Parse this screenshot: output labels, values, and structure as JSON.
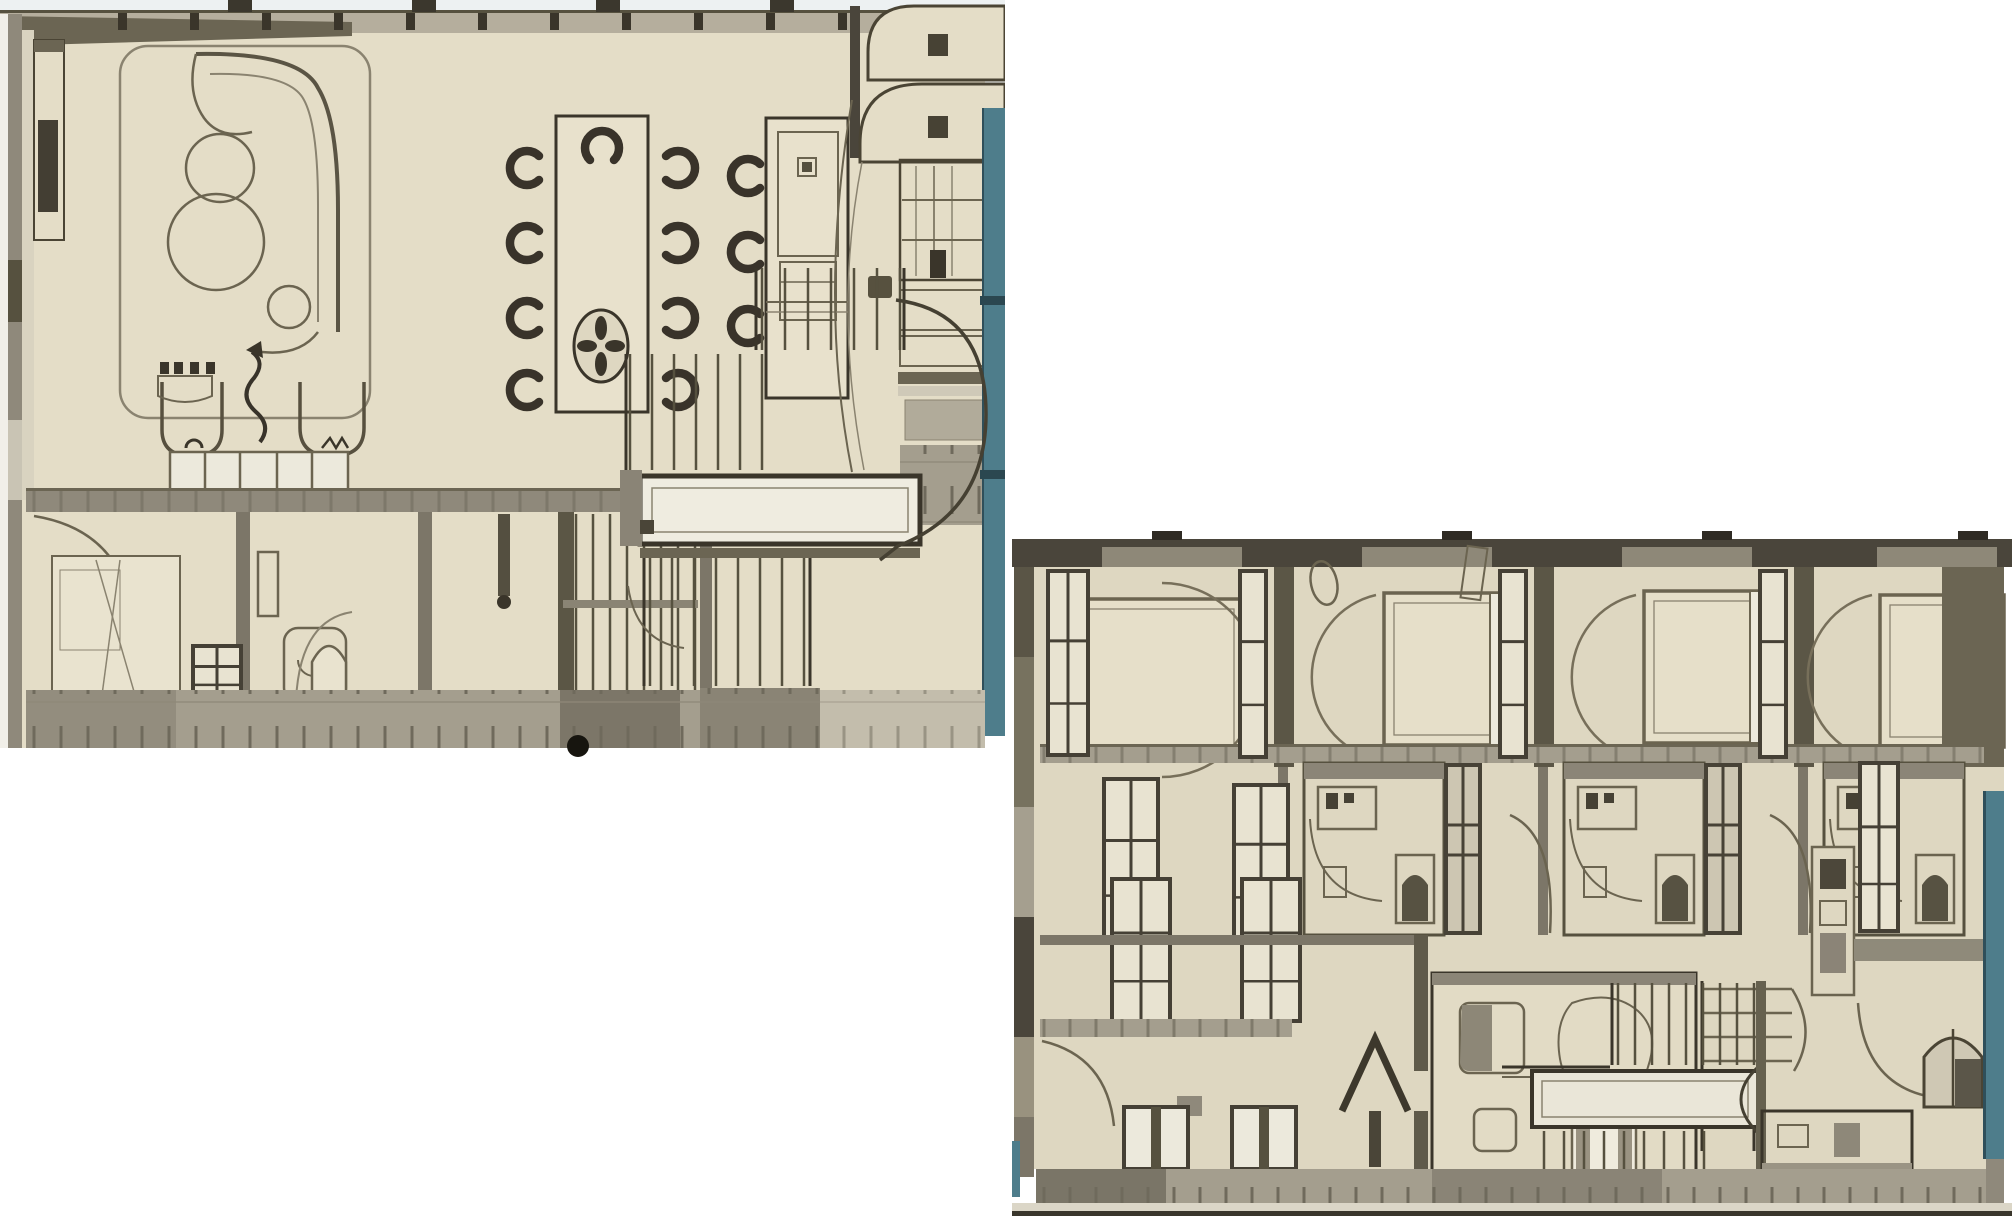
{
  "meta": {
    "description": "Two sepia hand-drawn architectural floor plans placed diagonally on a white background; no text labels are rendered in the image",
    "canvas": {
      "width": 2012,
      "height": 1216
    }
  },
  "palette": {
    "page_bg": "#ffffff",
    "top_light": "#edf1f2",
    "paper_a": "#e4ddc7",
    "paper_b": "#ded7c1",
    "paper_deep": "#d6cfba",
    "pane": "#ece9dc",
    "ink": "#4a4434",
    "ink_soft": "#8a8370",
    "line_mid": "#6b6450",
    "wall_dark": "#3a352a",
    "wall_olive": "#6b6553",
    "band_light": "#b5ae9d",
    "band_mid": "#a49e8e",
    "band_dark": "#7c7668",
    "gray_mid": "#8f897b",
    "gray_dark": "#56513f",
    "gray_deep": "#4a453b",
    "glass_teal": "#4e7d8b",
    "teal_dark": "#2f4f5a",
    "black": "#17150f",
    "chair_dark": "#39332a"
  },
  "panels": {
    "left": {
      "name": "living-dining-floor-plan",
      "x": 0,
      "y": 0,
      "w": 1005,
      "h": 762
    },
    "right": {
      "name": "bedroom-floor-plan",
      "x": 1012,
      "y": 511,
      "w": 1000,
      "h": 705
    }
  },
  "generated": {
    "top_ticks_a": {
      "y": 13,
      "w": 9,
      "h": 17,
      "xs": [
        118,
        190,
        262,
        334,
        406,
        478,
        550,
        622,
        694,
        766,
        838,
        910
      ]
    },
    "top_tabs_a": {
      "y": 0,
      "w": 24,
      "h": 12,
      "xs": [
        228,
        412,
        596,
        770
      ]
    },
    "top_tabs_b": {
      "y": 20,
      "w": 30,
      "h": 9,
      "xs": [
        140,
        430,
        690,
        946
      ]
    },
    "dining_chairs": [
      [
        527,
        168,
        0
      ],
      [
        527,
        243,
        0
      ],
      [
        527,
        318,
        0
      ],
      [
        527,
        390,
        0
      ],
      [
        678,
        168,
        180
      ],
      [
        678,
        243,
        180
      ],
      [
        678,
        318,
        180
      ],
      [
        678,
        390,
        180
      ],
      [
        602,
        148,
        90
      ]
    ],
    "island_chairs": [
      [
        748,
        176,
        0
      ],
      [
        748,
        252,
        0
      ],
      [
        748,
        326,
        0
      ]
    ],
    "treads_a": [
      [
        762,
        23,
        7,
        268,
        350
      ],
      [
        630,
        22,
        7,
        354,
        470
      ],
      [
        650,
        22,
        8,
        558,
        686
      ]
    ],
    "treads_b": [
      [
        606,
        17,
        9,
        472,
        554
      ],
      [
        532,
        20,
        9,
        620,
        686
      ]
    ],
    "louvers_a": [
      [
        576,
        17,
        8,
        514,
        738
      ]
    ],
    "beds_b": [
      [
        42,
        88,
        190,
        160,
        "left",
        "right"
      ],
      [
        372,
        82,
        136,
        152,
        "right",
        "left"
      ],
      [
        632,
        80,
        136,
        152,
        "right",
        "left"
      ],
      [
        868,
        84,
        124,
        152,
        "right",
        "left"
      ]
    ],
    "pods_b": [
      [
        292,
        252,
        1
      ],
      [
        552,
        252,
        1
      ],
      [
        812,
        252,
        0
      ]
    ],
    "windows_b": [
      [
        36,
        60,
        40,
        184
      ],
      [
        228,
        60,
        26,
        186
      ],
      [
        488,
        60,
        26,
        186
      ],
      [
        748,
        60,
        26,
        186
      ],
      [
        92,
        268,
        54,
        162
      ],
      [
        222,
        274,
        54,
        156
      ],
      [
        100,
        368,
        58,
        142
      ],
      [
        230,
        368,
        58,
        142
      ],
      [
        848,
        252,
        38,
        168
      ]
    ],
    "bottom_windows_b": [
      [
        112,
        596,
        64,
        62
      ],
      [
        220,
        596,
        64,
        62
      ]
    ],
    "windows_a": [
      [
        54,
        694,
        52,
        46
      ],
      [
        148,
        700,
        34,
        40
      ],
      [
        193,
        646,
        48,
        54
      ]
    ]
  }
}
